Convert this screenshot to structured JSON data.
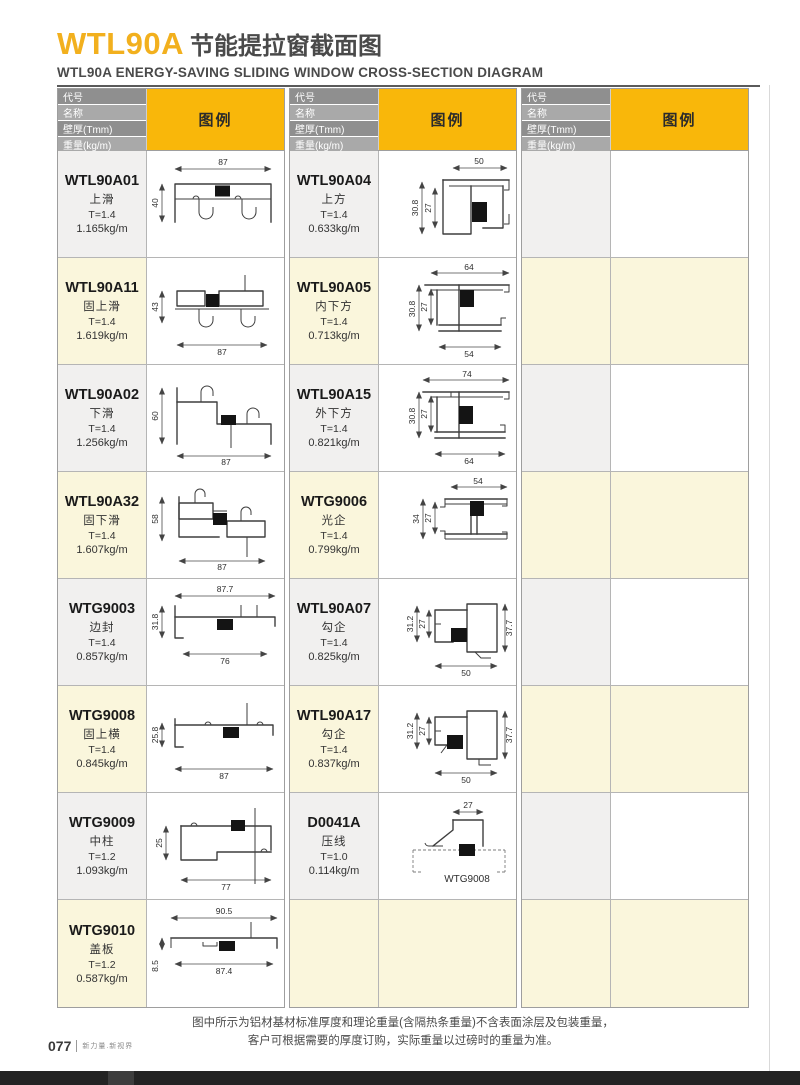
{
  "page": {
    "title_code": "WTL90A",
    "title_cn": "节能提拉窗截面图",
    "subtitle": "WTL90A ENERGY-SAVING SLIDING WINDOW CROSS-SECTION DIAGRAM",
    "footnote_line1": "图中所示为铝材基材标准厚度和理论重量(含隔热条重量)不含表面涂层及包装重量，",
    "footnote_line2": "客户可根据需要的厚度订购，实际重量以过磅时的重量为准。",
    "page_number": "077",
    "tagline": "新力量.新视界"
  },
  "colors": {
    "accent_yellow": "#F9B70A",
    "title_yellow": "#F2B01E",
    "header_gray_dark": "#8F8F8F",
    "header_gray_light": "#A9A9A9",
    "row_cream": "#FAF6DC",
    "row_gray": "#F1F0EF"
  },
  "table_header": {
    "col_code": "代号",
    "col_name": "名称",
    "col_thickness": "壁厚(Tmm)",
    "col_weight": "重量(kg/m)",
    "col_legend": "图例"
  },
  "products": {
    "c1r1": {
      "code": "WTL90A01",
      "name": "上滑",
      "thickness": "T=1.4",
      "weight": "1.165kg/m",
      "dims": {
        "t": "87",
        "l": "40"
      }
    },
    "c1r2": {
      "code": "WTL90A11",
      "name": "固上滑",
      "thickness": "T=1.4",
      "weight": "1.619kg/m",
      "dims": {
        "l": "43",
        "b": "87"
      }
    },
    "c1r3": {
      "code": "WTL90A02",
      "name": "下滑",
      "thickness": "T=1.4",
      "weight": "1.256kg/m",
      "dims": {
        "l": "60",
        "b": "87"
      }
    },
    "c1r4": {
      "code": "WTL90A32",
      "name": "固下滑",
      "thickness": "T=1.4",
      "weight": "1.607kg/m",
      "dims": {
        "l": "58",
        "b": "87"
      }
    },
    "c1r5": {
      "code": "WTG9003",
      "name": "边封",
      "thickness": "T=1.4",
      "weight": "0.857kg/m",
      "dims": {
        "t": "87.7",
        "l": "31.8",
        "b": "76"
      }
    },
    "c1r6": {
      "code": "WTG9008",
      "name": "固上横",
      "thickness": "T=1.4",
      "weight": "0.845kg/m",
      "dims": {
        "l": "25.8",
        "b": "87"
      }
    },
    "c1r7": {
      "code": "WTG9009",
      "name": "中柱",
      "thickness": "T=1.2",
      "weight": "1.093kg/m",
      "dims": {
        "l": "25",
        "b": "77"
      }
    },
    "c1r8": {
      "code": "WTG9010",
      "name": "盖板",
      "thickness": "T=1.2",
      "weight": "0.587kg/m",
      "dims": {
        "t": "90.5",
        "m": "87.4",
        "l": "8.5"
      }
    },
    "c2r1": {
      "code": "WTL90A04",
      "name": "上方",
      "thickness": "T=1.4",
      "weight": "0.633kg/m",
      "dims": {
        "t": "50",
        "l": "30.8",
        "l2": "27"
      }
    },
    "c2r2": {
      "code": "WTL90A05",
      "name": "内下方",
      "thickness": "T=1.4",
      "weight": "0.713kg/m",
      "dims": {
        "t": "64",
        "l": "30.8",
        "l2": "27",
        "b": "54"
      }
    },
    "c2r3": {
      "code": "WTL90A15",
      "name": "外下方",
      "thickness": "T=1.4",
      "weight": "0.821kg/m",
      "dims": {
        "t": "74",
        "l": "30.8",
        "l2": "27",
        "b": "64"
      }
    },
    "c2r4": {
      "code": "WTG9006",
      "name": "光企",
      "thickness": "T=1.4",
      "weight": "0.799kg/m",
      "dims": {
        "t": "54",
        "l": "34",
        "l2": "27"
      }
    },
    "c2r5": {
      "code": "WTL90A07",
      "name": "勾企",
      "thickness": "T=1.4",
      "weight": "0.825kg/m",
      "dims": {
        "l": "31.2",
        "l2": "27",
        "r": "37.7",
        "b": "50"
      }
    },
    "c2r6": {
      "code": "WTL90A17",
      "name": "勾企",
      "thickness": "T=1.4",
      "weight": "0.837kg/m",
      "dims": {
        "l": "31.2",
        "l2": "27",
        "r": "37.7",
        "b": "50"
      }
    },
    "c2r7": {
      "code": "D0041A",
      "name": "压线",
      "thickness": "T=1.0",
      "weight": "0.114kg/m",
      "dims": {
        "t": "27"
      },
      "ref": "WTG9008"
    }
  }
}
